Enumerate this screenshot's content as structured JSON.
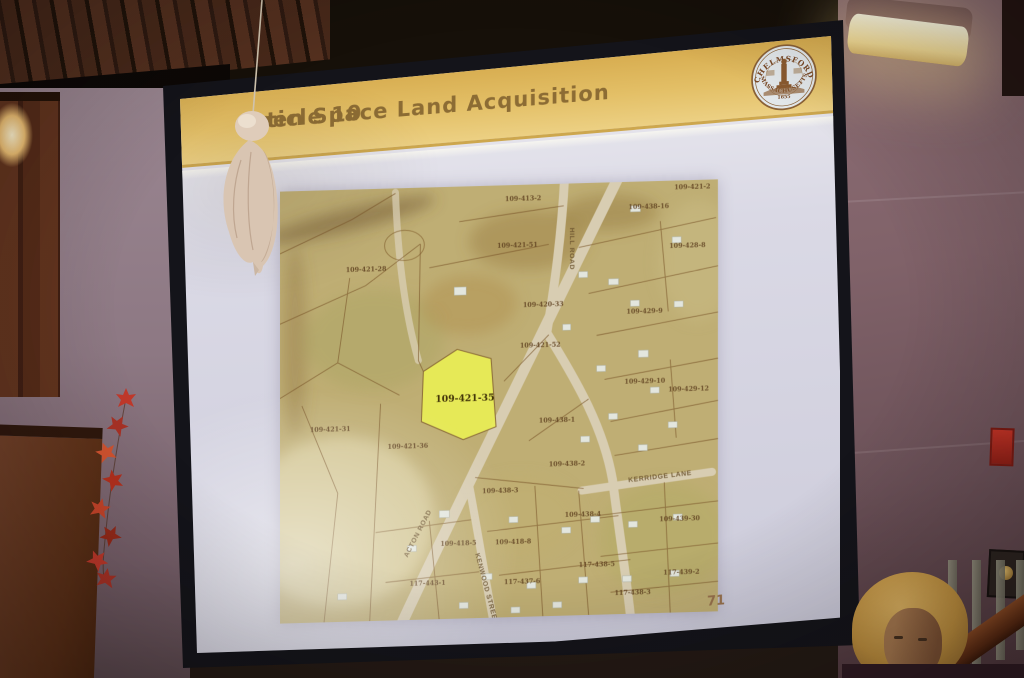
{
  "slide": {
    "article_label": "Article 10",
    "title": "Open Space Land Acquisition",
    "page_number": "71",
    "seal": {
      "top": "CHELMSFORD",
      "bottom": "MASSACHUSETTS",
      "year": "1655"
    },
    "colors": {
      "band_gold": "#e0ba60",
      "slide_body": "#d6d5e2",
      "title_text": "#8c6c34",
      "screen_frame": "#14141a"
    }
  },
  "map": {
    "base_color": "#bfae74",
    "highlight_color": "#e9ee55",
    "highlighted_parcel": "109-421-35",
    "parcel_labels": [
      {
        "id": "109-413-2",
        "x": 226,
        "y": 16
      },
      {
        "id": "109-421-2",
        "x": 396,
        "y": 9
      },
      {
        "id": "109-438-16",
        "x": 350,
        "y": 27
      },
      {
        "id": "109-421-51",
        "x": 218,
        "y": 62
      },
      {
        "id": "109-421-28",
        "x": 66,
        "y": 82
      },
      {
        "id": "109-428-8",
        "x": 391,
        "y": 67
      },
      {
        "id": "109-420-33",
        "x": 244,
        "y": 122
      },
      {
        "id": "109-429-9",
        "x": 348,
        "y": 131
      },
      {
        "id": "109-421-52",
        "x": 241,
        "y": 162
      },
      {
        "id": "109-429-10",
        "x": 346,
        "y": 201
      },
      {
        "id": "109-429-12",
        "x": 390,
        "y": 210
      },
      {
        "id": "109-421-35",
        "x": 156,
        "y": 214,
        "em": true
      },
      {
        "id": "109-438-1",
        "x": 260,
        "y": 237
      },
      {
        "id": "109-421-31",
        "x": 30,
        "y": 240
      },
      {
        "id": "109-421-36",
        "x": 108,
        "y": 259
      },
      {
        "id": "109-438-2",
        "x": 270,
        "y": 281
      },
      {
        "id": "109-438-3",
        "x": 203,
        "y": 306
      },
      {
        "id": "109-438-4",
        "x": 286,
        "y": 332
      },
      {
        "id": "109-439-30",
        "x": 381,
        "y": 339
      },
      {
        "id": "109-418-5",
        "x": 161,
        "y": 357
      },
      {
        "id": "109-418-8",
        "x": 216,
        "y": 357
      },
      {
        "id": "117-438-5",
        "x": 300,
        "y": 382
      },
      {
        "id": "117-439-2",
        "x": 385,
        "y": 392
      },
      {
        "id": "117-443-1",
        "x": 130,
        "y": 396
      },
      {
        "id": "117-437-6",
        "x": 225,
        "y": 397
      },
      {
        "id": "117-438-3",
        "x": 336,
        "y": 411
      }
    ],
    "road_labels": [
      {
        "name": "HILL ROAD",
        "x": 291,
        "y": 44,
        "rot": 90
      },
      {
        "name": "ACTON ROAD",
        "x": 128,
        "y": 368,
        "rot": -62
      },
      {
        "name": "KENWOOD STREET",
        "x": 196,
        "y": 366,
        "rot": 75
      },
      {
        "name": "KERRIDGE LANE",
        "x": 350,
        "y": 299,
        "rot": -5
      }
    ]
  },
  "scene": {
    "objects": {
      "hanging_decoration": "tissue-ghost-decoration",
      "left_decoration": "autumn-leaf-garland",
      "audience_member": "blonde-woman-head",
      "right_wall": [
        "fluorescent-wall-light",
        "red-fire-alarm",
        "plaque-with-gold-dot",
        "stair-railing"
      ]
    },
    "colors": {
      "wall_mauve": "#8a6b72",
      "wood_panel": "#5f3322",
      "board_brown": "#6e3f26"
    }
  }
}
